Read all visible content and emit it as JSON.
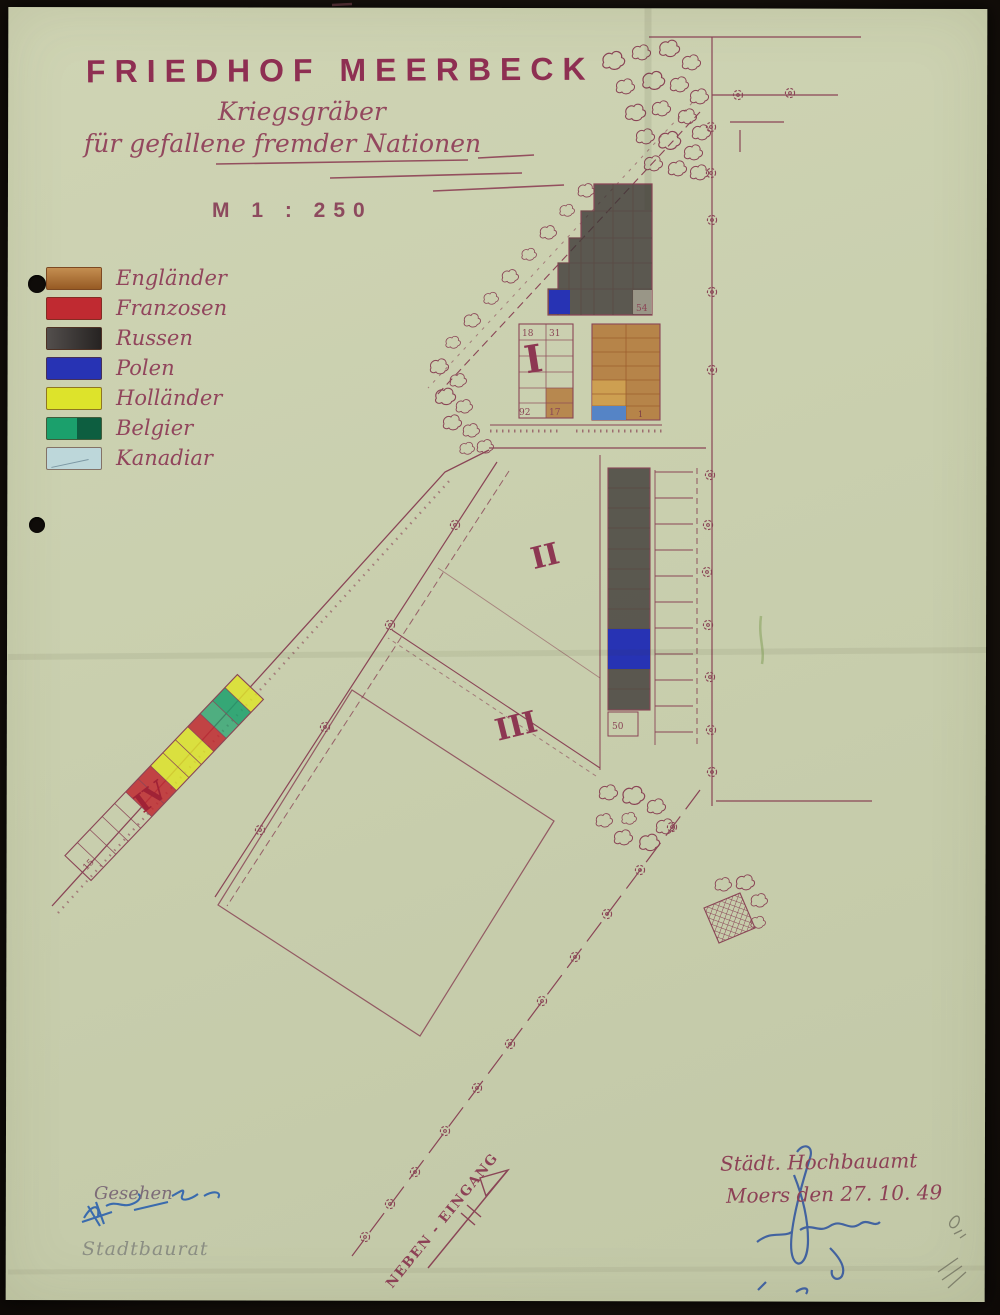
{
  "header": {
    "title": "FRIEDHOF MEERBECK",
    "subtitle1": "Kriegsgräber",
    "subtitle2": "für gefallene fremder Nationen",
    "scale": "M 1 : 250"
  },
  "legend": {
    "items": [
      {
        "label": "Engländer",
        "color": "#b0702f"
      },
      {
        "label": "Franzosen",
        "color": "#c02a31"
      },
      {
        "label": "Russen",
        "color": "#3b3634"
      },
      {
        "label": "Polen",
        "color": "#2733b4"
      },
      {
        "label": "Holländer",
        "color": "#dde32b"
      },
      {
        "label": "Belgier",
        "color": "#1ba06c"
      },
      {
        "label": "Kanadiar",
        "color": "#bdd7da"
      }
    ]
  },
  "map": {
    "plot_labels": [
      "I",
      "II",
      "III",
      "IV"
    ],
    "grave_numbers": [
      "18",
      "31",
      "92",
      "17",
      "54",
      "1",
      "50",
      "15"
    ],
    "entrance_label": "NEBEN - EINGANG"
  },
  "footer": {
    "approved": "Gesehen",
    "approver_title": "Stadtbaurat",
    "office": "Städt. Hochbauamt",
    "place_date": "Moers den 27. 10. 49"
  },
  "colors": {
    "paper": "#c9cfae",
    "ink": "#8a4556",
    "scan_background": "#15100b",
    "signature_blue": "#2f63ae",
    "pencil_gray": "#70705f",
    "canadian_grave_cell": "#5584c6"
  }
}
